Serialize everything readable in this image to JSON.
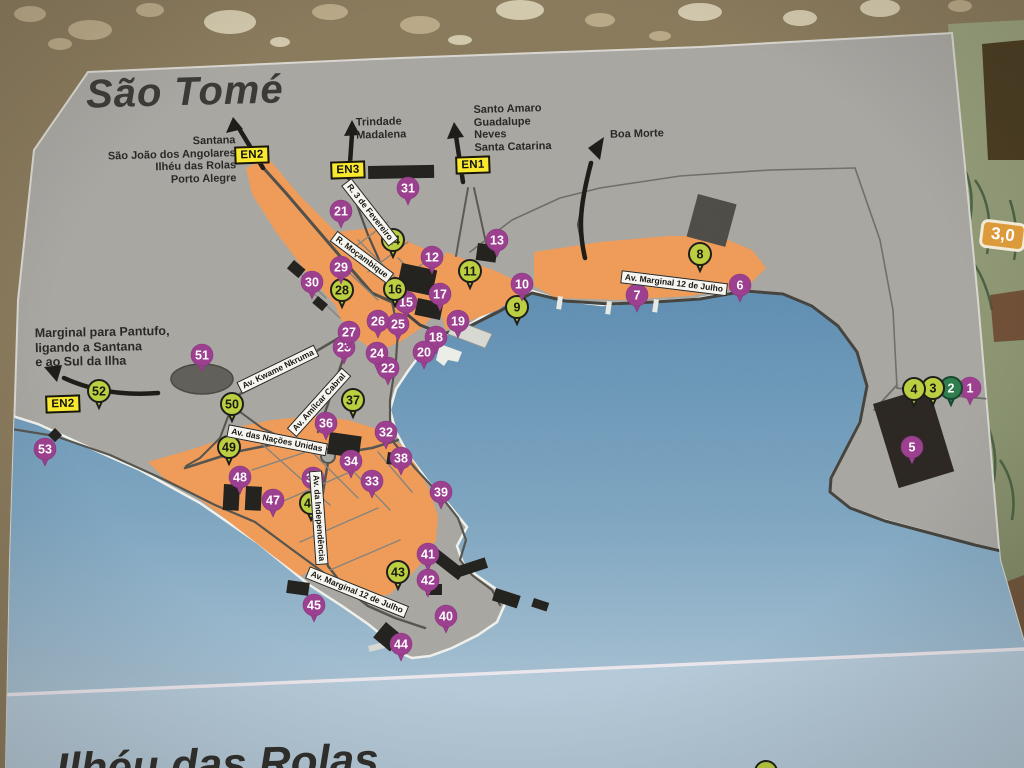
{
  "page": {
    "title": "São Tomé",
    "bottom_section_title": "Ilhéu das Rolas",
    "price_badge": "3,0"
  },
  "annotations": {
    "sw_note": {
      "line1": "Marginal para Pantufo,",
      "line2": "ligando a Santana",
      "line3": "e ao Sul da Ilha"
    },
    "destinations": {
      "south": {
        "lines": [
          "Santana",
          "São João dos Angolares",
          "Ilhéu das Rolas",
          "Porto Alegre"
        ]
      },
      "trindade": {
        "lines": [
          "Trindade",
          "Madalena"
        ]
      },
      "north": {
        "lines": [
          "Santo Amaro",
          "Guadalupe",
          "Neves",
          "Santa Catarina"
        ]
      },
      "east": {
        "lines": [
          "Boa Morte"
        ]
      }
    }
  },
  "road_badges": [
    {
      "label": "EN2",
      "x": 252,
      "y": 155
    },
    {
      "label": "EN3",
      "x": 348,
      "y": 170
    },
    {
      "label": "EN1",
      "x": 473,
      "y": 165
    },
    {
      "label": "EN2",
      "x": 63,
      "y": 404
    }
  ],
  "streets": [
    {
      "name": "R. 3 de Fevereiro",
      "x": 370,
      "y": 212,
      "angle": 52
    },
    {
      "name": "R. Moçambique",
      "x": 362,
      "y": 257,
      "angle": 37
    },
    {
      "name": "Av. Marginal 12 de Julho",
      "x": 674,
      "y": 283,
      "angle": 7
    },
    {
      "name": "Av. Kwame Nkruma",
      "x": 278,
      "y": 369,
      "angle": -26
    },
    {
      "name": "Av. Amílcar Cabral",
      "x": 319,
      "y": 402,
      "angle": -48
    },
    {
      "name": "Av. das Nações Unidas",
      "x": 277,
      "y": 440,
      "angle": 11
    },
    {
      "name": "Av. da Independência",
      "x": 319,
      "y": 518,
      "angle": 86
    },
    {
      "name": "Av. Marginal 12 de Julho",
      "x": 357,
      "y": 592,
      "angle": 22
    }
  ],
  "markers": [
    {
      "n": 1,
      "x": 970,
      "y": 388,
      "type": "purple"
    },
    {
      "n": 2,
      "x": 951,
      "y": 388,
      "type": "darkgreen"
    },
    {
      "n": 3,
      "x": 933,
      "y": 388,
      "type": "green"
    },
    {
      "n": 4,
      "x": 914,
      "y": 389,
      "type": "green"
    },
    {
      "n": 5,
      "x": 912,
      "y": 447,
      "type": "purple"
    },
    {
      "n": 6,
      "x": 740,
      "y": 285,
      "type": "purple"
    },
    {
      "n": 7,
      "x": 637,
      "y": 295,
      "type": "purple"
    },
    {
      "n": 8,
      "x": 700,
      "y": 254,
      "type": "green"
    },
    {
      "n": 9,
      "x": 517,
      "y": 307,
      "type": "green"
    },
    {
      "n": 10,
      "x": 522,
      "y": 284,
      "type": "purple"
    },
    {
      "n": 11,
      "x": 470,
      "y": 271,
      "type": "green"
    },
    {
      "n": 12,
      "x": 432,
      "y": 257,
      "type": "purple"
    },
    {
      "n": 13,
      "x": 497,
      "y": 240,
      "type": "purple"
    },
    {
      "n": 14,
      "x": 393,
      "y": 240,
      "type": "green"
    },
    {
      "n": 15,
      "x": 406,
      "y": 302,
      "type": "purple"
    },
    {
      "n": 16,
      "x": 395,
      "y": 289,
      "type": "green"
    },
    {
      "n": 17,
      "x": 440,
      "y": 294,
      "type": "purple"
    },
    {
      "n": 18,
      "x": 436,
      "y": 337,
      "type": "purple"
    },
    {
      "n": 19,
      "x": 458,
      "y": 321,
      "type": "purple"
    },
    {
      "n": 20,
      "x": 424,
      "y": 352,
      "type": "purple"
    },
    {
      "n": 21,
      "x": 341,
      "y": 211,
      "type": "purple"
    },
    {
      "n": 22,
      "x": 388,
      "y": 368,
      "type": "purple"
    },
    {
      "n": 23,
      "x": 344,
      "y": 347,
      "type": "purple"
    },
    {
      "n": 24,
      "x": 377,
      "y": 353,
      "type": "purple"
    },
    {
      "n": 25,
      "x": 398,
      "y": 324,
      "type": "purple"
    },
    {
      "n": 26,
      "x": 378,
      "y": 321,
      "type": "purple"
    },
    {
      "n": 27,
      "x": 349,
      "y": 332,
      "type": "purple"
    },
    {
      "n": 28,
      "x": 342,
      "y": 290,
      "type": "green"
    },
    {
      "n": 29,
      "x": 341,
      "y": 267,
      "type": "purple"
    },
    {
      "n": 30,
      "x": 312,
      "y": 282,
      "type": "purple"
    },
    {
      "n": 31,
      "x": 408,
      "y": 188,
      "type": "purple"
    },
    {
      "n": 32,
      "x": 386,
      "y": 432,
      "type": "purple"
    },
    {
      "n": 33,
      "x": 372,
      "y": 481,
      "type": "purple"
    },
    {
      "n": 34,
      "x": 351,
      "y": 461,
      "type": "purple"
    },
    {
      "n": 35,
      "x": 313,
      "y": 478,
      "type": "purple"
    },
    {
      "n": 36,
      "x": 326,
      "y": 423,
      "type": "purple"
    },
    {
      "n": 37,
      "x": 353,
      "y": 400,
      "type": "green"
    },
    {
      "n": 38,
      "x": 401,
      "y": 458,
      "type": "purple"
    },
    {
      "n": 39,
      "x": 441,
      "y": 492,
      "type": "purple"
    },
    {
      "n": 40,
      "x": 446,
      "y": 616,
      "type": "purple"
    },
    {
      "n": 41,
      "x": 428,
      "y": 554,
      "type": "purple"
    },
    {
      "n": 42,
      "x": 428,
      "y": 580,
      "type": "purple"
    },
    {
      "n": 43,
      "x": 398,
      "y": 572,
      "type": "green"
    },
    {
      "n": 44,
      "x": 401,
      "y": 644,
      "type": "purple"
    },
    {
      "n": 45,
      "x": 314,
      "y": 605,
      "type": "purple"
    },
    {
      "n": 46,
      "x": 311,
      "y": 503,
      "type": "green"
    },
    {
      "n": 47,
      "x": 273,
      "y": 500,
      "type": "purple"
    },
    {
      "n": 48,
      "x": 240,
      "y": 477,
      "type": "purple"
    },
    {
      "n": 49,
      "x": 229,
      "y": 447,
      "type": "green"
    },
    {
      "n": 50,
      "x": 232,
      "y": 404,
      "type": "green"
    },
    {
      "n": 51,
      "x": 202,
      "y": 355,
      "type": "purple"
    },
    {
      "n": 52,
      "x": 99,
      "y": 391,
      "type": "green"
    },
    {
      "n": 53,
      "x": 45,
      "y": 449,
      "type": "purple"
    },
    {
      "n": "",
      "x": 766,
      "y": 772,
      "type": "green"
    }
  ],
  "colors": {
    "marker": {
      "purple": {
        "fill": "#9c3e8f",
        "stroke": "#86357b",
        "sw": 0.6,
        "text": "#ffffff"
      },
      "green": {
        "fill": "#bccf3f",
        "stroke": "#1c1c18",
        "sw": 2,
        "text": "#16160f"
      },
      "darkgreen": {
        "fill": "#2e7c4e",
        "stroke": "#15462b",
        "sw": 2,
        "text": "#ffffff"
      }
    },
    "water": "#5f8eb2",
    "land": "#a9a7a2",
    "urban": "#f09b58",
    "badge_yellow": "#f8e82e",
    "price_badge_bg": "#dd9a3b"
  }
}
